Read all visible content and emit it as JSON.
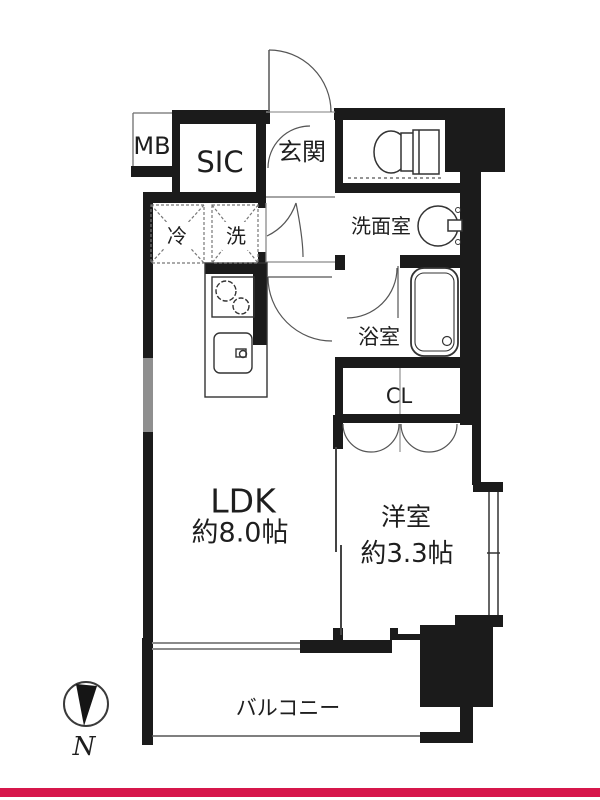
{
  "page": {
    "background_color": "#ffffff",
    "accent_line_color": "#d6164b"
  },
  "floorplan": {
    "rooms": {
      "meter_box": {
        "label": "MB"
      },
      "shoe_closet": {
        "label": "SIC"
      },
      "entrance": {
        "label": "玄関"
      },
      "washroom": {
        "label": "洗面室"
      },
      "refrigerator_space": {
        "label": "冷"
      },
      "washer_space": {
        "label": "洗"
      },
      "bathroom": {
        "label": "浴室"
      },
      "closet": {
        "label": "CL"
      },
      "ldk": {
        "label": "LDK",
        "size": "約8.0帖"
      },
      "western_room": {
        "label": "洋室",
        "size": "約3.3帖"
      },
      "balcony": {
        "label": "バルコニー"
      }
    },
    "compass": {
      "label": "N"
    },
    "icons": [
      "compass-icon",
      "toilet-icon",
      "wash-basin-icon",
      "bathtub-icon",
      "stove-icon",
      "kitchen-sink-icon",
      "refrigerator-box",
      "washer-box"
    ]
  }
}
